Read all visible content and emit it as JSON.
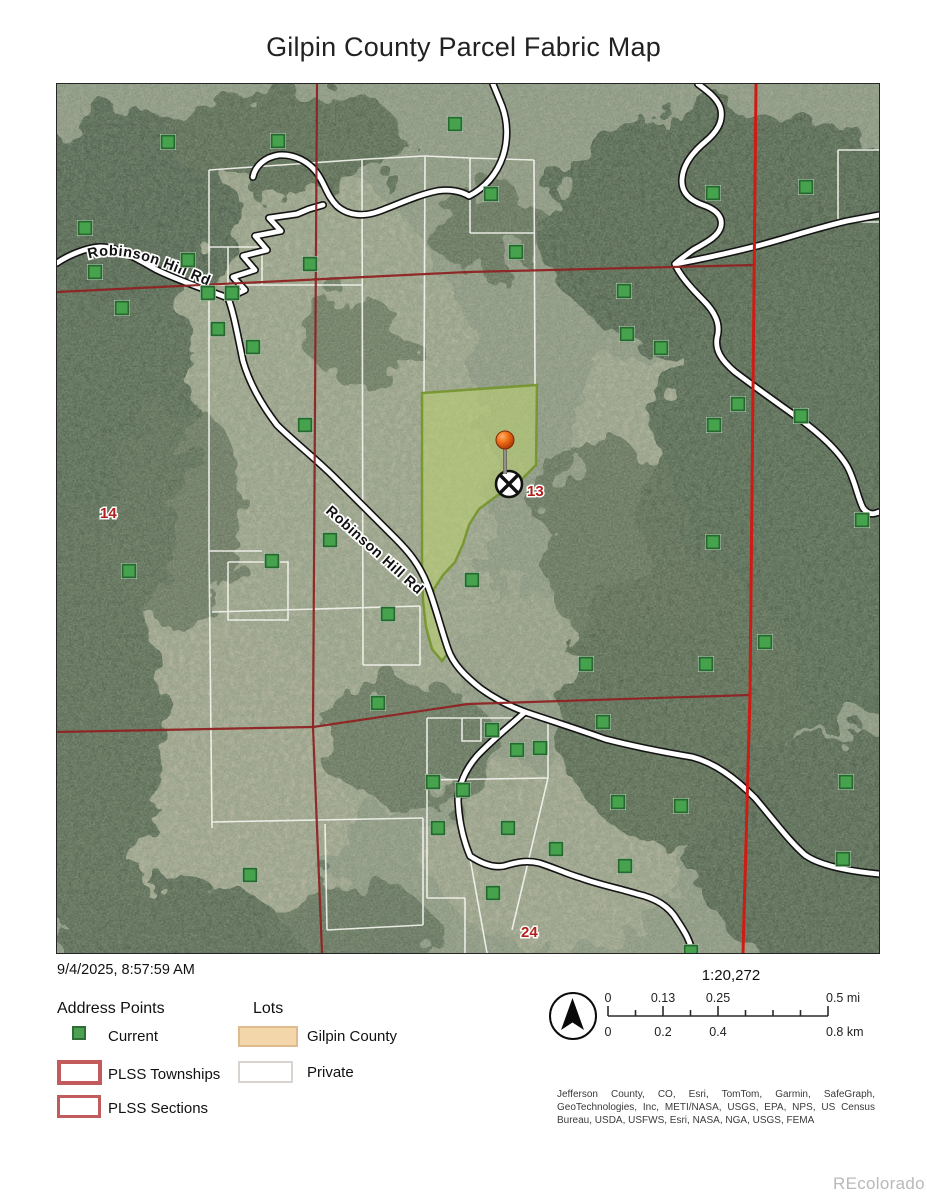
{
  "title": "Gilpin County Parcel Fabric Map",
  "timestamp": "9/4/2025, 8:57:59 AM",
  "watermark": "REcolorado",
  "legend": {
    "address_points": {
      "header": "Address Points",
      "items": [
        {
          "label": "Current",
          "swatch": "green-square"
        },
        {
          "label": "PLSS Townships",
          "swatch": "red-outline-thick"
        },
        {
          "label": "PLSS Sections",
          "swatch": "red-outline-thin"
        }
      ]
    },
    "lots": {
      "header": "Lots",
      "items": [
        {
          "label": "Gilpin County",
          "swatch": "tan-fill"
        },
        {
          "label": "Private",
          "swatch": "white-outline"
        }
      ]
    }
  },
  "scale": {
    "ratio": "1:20,272",
    "mi_labels": [
      "0",
      "0.13",
      "0.25",
      "0.5 mi"
    ],
    "km_labels": [
      "0",
      "0.2",
      "0.4",
      "0.8 km"
    ]
  },
  "attribution": "Jefferson County, CO, Esri, TomTom, Garmin, SafeGraph, GeoTechnologies, Inc, METI/NASA, USGS, EPA, NPS, US Census Bureau, USDA, USFWS, Esri, NASA, NGA, USGS, FEMA",
  "map": {
    "road_label": "Robinson Hill Rd",
    "section_labels": [
      {
        "text": "14",
        "x": 43,
        "y": 434
      },
      {
        "text": "13",
        "x": 470,
        "y": 412
      },
      {
        "text": "24",
        "x": 464,
        "y": 853
      }
    ],
    "pin": {
      "x": 448,
      "y": 358
    },
    "crossed_circle": {
      "x": 452,
      "y": 400
    },
    "address_points": [
      [
        111,
        58
      ],
      [
        221,
        57
      ],
      [
        398,
        40
      ],
      [
        28,
        144
      ],
      [
        131,
        176
      ],
      [
        38,
        188
      ],
      [
        253,
        180
      ],
      [
        151,
        209
      ],
      [
        175,
        209
      ],
      [
        65,
        224
      ],
      [
        161,
        245
      ],
      [
        196,
        263
      ],
      [
        248,
        341
      ],
      [
        434,
        110
      ],
      [
        459,
        168
      ],
      [
        656,
        109
      ],
      [
        749,
        103
      ],
      [
        567,
        207
      ],
      [
        570,
        250
      ],
      [
        604,
        264
      ],
      [
        681,
        320
      ],
      [
        744,
        332
      ],
      [
        657,
        341
      ],
      [
        805,
        436
      ],
      [
        72,
        487
      ],
      [
        215,
        477
      ],
      [
        273,
        456
      ],
      [
        331,
        530
      ],
      [
        415,
        496
      ],
      [
        321,
        619
      ],
      [
        376,
        698
      ],
      [
        406,
        706
      ],
      [
        435,
        646
      ],
      [
        460,
        666
      ],
      [
        483,
        664
      ],
      [
        381,
        744
      ],
      [
        451,
        744
      ],
      [
        436,
        809
      ],
      [
        193,
        791
      ],
      [
        656,
        458
      ],
      [
        708,
        558
      ],
      [
        529,
        580
      ],
      [
        649,
        580
      ],
      [
        546,
        638
      ],
      [
        789,
        698
      ],
      [
        624,
        722
      ],
      [
        561,
        718
      ],
      [
        499,
        765
      ],
      [
        786,
        775
      ],
      [
        568,
        782
      ],
      [
        634,
        868
      ]
    ],
    "colors": {
      "address_point": "#47a24e",
      "plss_dark_red": "#8e2323",
      "plss_bright_red": "#cf1b13",
      "highlight_fill": "#b9cf72",
      "highlight_border": "#74942c",
      "township_red": "#c25b5b",
      "gilpin_tan": "#f3d7ab"
    }
  }
}
